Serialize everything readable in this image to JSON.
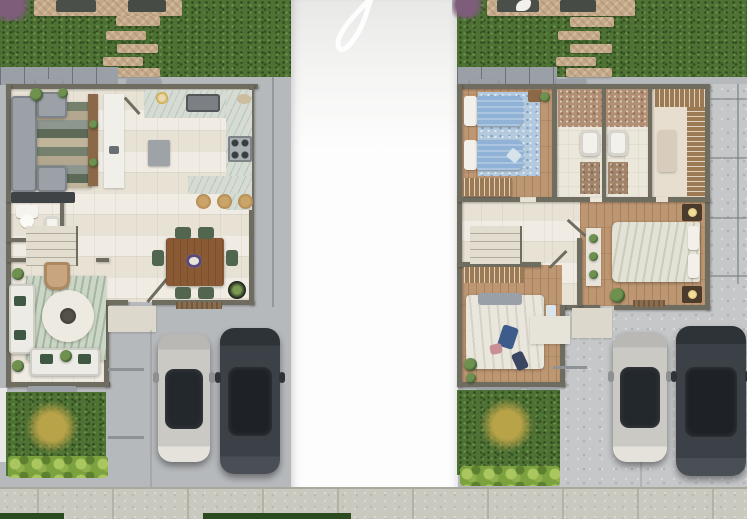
{
  "scene": {
    "type": "architectural-floor-plan-aerial-render",
    "view": "top-down",
    "center_overlay": {
      "kind": "white-vertical-panel",
      "watermark": "faint-script-letter-loop"
    },
    "units": [
      {
        "id": "left-unit",
        "plan": "ground-floor",
        "rooms": [
          "family-room",
          "hall-counter",
          "kitchen",
          "half-bath",
          "staircase",
          "living-room",
          "dining-area",
          "entry-porch"
        ],
        "furniture": [
          "sectional-sofa",
          "striped-rug",
          "media-console",
          "kitchen-sink",
          "cooktop",
          "refrigerator",
          "breakfast-bar",
          "bar-stools-x3",
          "toilet",
          "bathroom-sink",
          "white-sofas-x2",
          "armchair",
          "round-rug",
          "coffee-table",
          "dining-table",
          "dining-chairs-x6",
          "potted-plants"
        ],
        "exterior": [
          "backyard-lawn",
          "wood-deck",
          "stepping-stones-x5",
          "purple-shrub",
          "front-lawn",
          "yellow-flower-shrub",
          "hedge",
          "driveway",
          "parking-lines"
        ],
        "vehicles": [
          "silver-car",
          "dark-gray-car"
        ]
      },
      {
        "id": "right-unit",
        "plan": "upper-floor",
        "rooms": [
          "twin-bedroom",
          "bathroom-1",
          "bathroom-2",
          "walk-in-closet",
          "hallway-staircase",
          "master-bedroom",
          "bedroom-2",
          "entry-porch"
        ],
        "furniture": [
          "twin-beds-x2",
          "blue-rug",
          "wardrobes",
          "bathroom-vanities-x2",
          "shower-stalls-x2",
          "master-bed",
          "nightstands-x2",
          "table-lamps",
          "display-shelf",
          "bedroom2-bed",
          "window-curtain",
          "potted-plants"
        ],
        "exterior": [
          "backyard-lawn",
          "wood-deck",
          "stepping-stones-x5",
          "purple-shrub",
          "front-lawn",
          "yellow-flower-shrub",
          "hedge",
          "driveway",
          "parking-lines"
        ],
        "vehicles": [
          "silver-car",
          "dark-gray-suv"
        ]
      }
    ],
    "street": {
      "sidewalk": true,
      "lawn_patches": 2
    }
  },
  "colors": {
    "grass_mid": "#4e7134",
    "hedge": "#7ca23f",
    "hedge_light": "#a9c75e",
    "bush_yellow": "#b9a348",
    "bush_purple": "#7d5d7a",
    "concrete": "#b6b9bc",
    "concrete_light": "#c5c7c9",
    "sidewalk": "#c9c9c0",
    "stone": "#c6ab8b",
    "wall": "#6f6d60",
    "floor_tile": "#e8e2d5",
    "floor_wood": "#bd9672",
    "marble": "#d6dbd3",
    "sofa_gray": "#9ba1a6",
    "sofa_white": "#edebe5",
    "table_wood": "#8a5a34",
    "chair_green": "#51654f",
    "bed_blue": "#8fb2d6",
    "bed_sage": "#e4e2d6",
    "doormat": "#8a6d4e",
    "car_silver": "#cac9c4",
    "car_dark": "#3c4147",
    "glass_dark": "#23282d",
    "watermark": "#ffffff"
  }
}
